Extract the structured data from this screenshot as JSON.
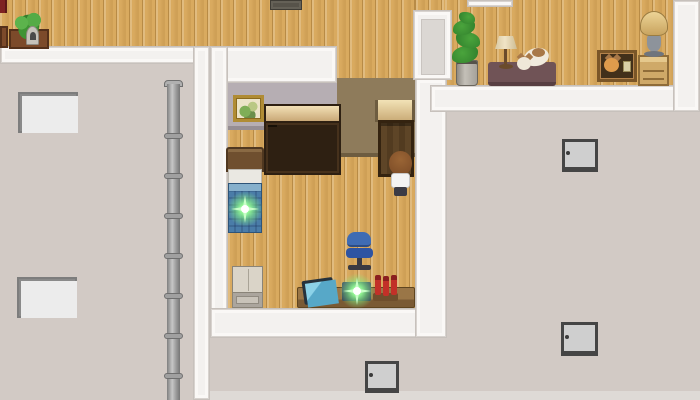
{
  "palette": {
    "wood": "#d9aa5f",
    "exterior_wall": "#d2cac5",
    "trim_white": "#f3f1ef",
    "interior_wall_gray": "#b6aeb3",
    "interior_wall_brown": "#8e7b5b",
    "blanket_blue": "#4a7ca8",
    "window_pane": "#e4f3f8",
    "sparkle_green": "#c8ffc8"
  },
  "bookshelf": {
    "rows": [
      [
        "#b22a2a",
        "#cc3a2e",
        "#2f62b4",
        "#3a74c4",
        "#2f8f3f",
        "#45a84f",
        "#d9a92c",
        "#c2542a"
      ],
      [
        "#2f62b4",
        "#3a74c4",
        "#e0cf6a",
        "#bb2d2d",
        "#cc3a2e",
        "#191510",
        "#191510"
      ],
      [
        "#2f8f3f",
        "#2fa0ae",
        "#2f62b4",
        "#3a74c4",
        "#c23a30",
        "#4a5cc0",
        "#9a4ab0"
      ]
    ]
  },
  "rooms": {
    "top_hallway": {
      "items": [
        "red-object",
        "planter-with-bush",
        "stone-ornament",
        "doormat"
      ]
    },
    "study_room": {
      "items": [
        "wall-picture",
        "bookshelf",
        "bed",
        "glowing-item-on-bed",
        "refrigerator",
        "office-chair",
        "television",
        "desk",
        "laptop-with-glow",
        "red-vials",
        "door",
        "player-character"
      ]
    },
    "right_room": {
      "items": [
        "potted-plant",
        "side-table",
        "table-lamp",
        "cat-on-table",
        "crate-with-cat",
        "nightstand",
        "floor-lamp"
      ]
    },
    "exterior": {
      "items": [
        "drain-pipe",
        "window-4pane-upper",
        "window-4pane-lower",
        "window-2pane-upper",
        "window-2pane-lower",
        "window-2pane-bottom"
      ]
    }
  }
}
